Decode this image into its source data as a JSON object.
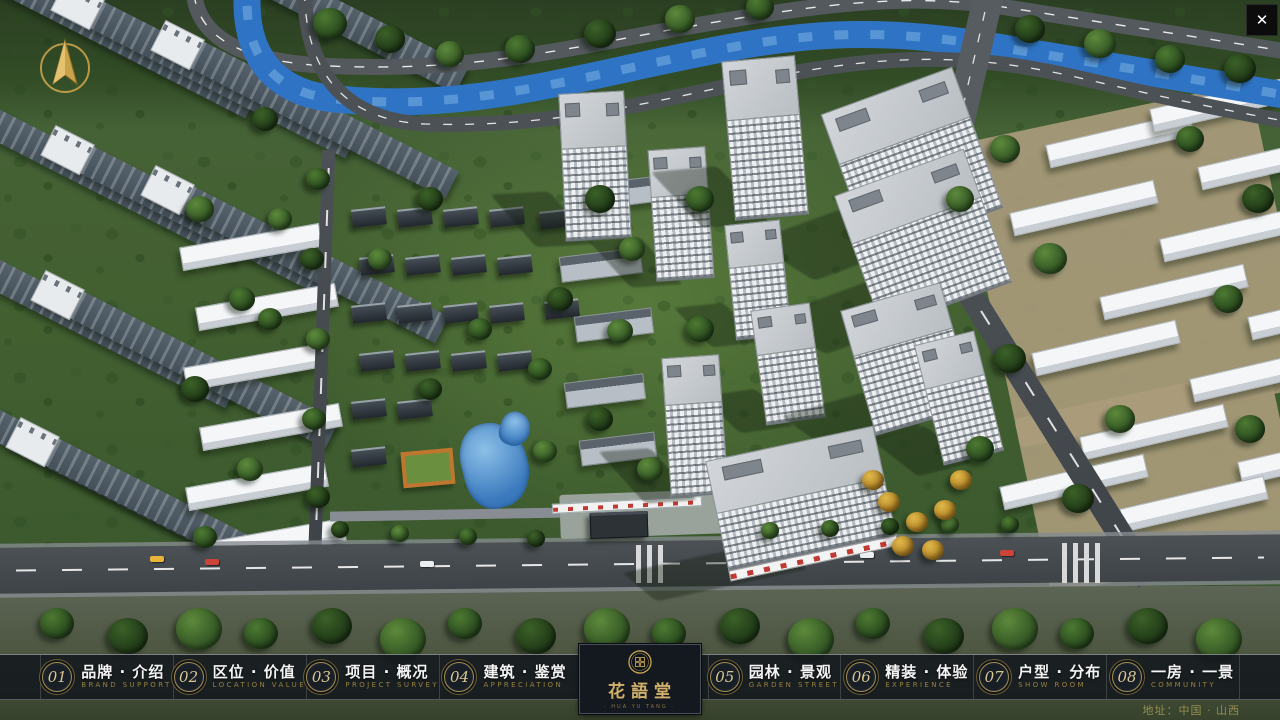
{
  "window": {
    "title": "花語堂 楼盘展示系统"
  },
  "icons": {
    "close": "✕",
    "compass": "north-arrow",
    "logo_seal": "hua-yu-tang-seal"
  },
  "nav": {
    "items": [
      {
        "num": "01",
        "label": "品牌 · 介绍",
        "sub": "BRAND SUPPORT"
      },
      {
        "num": "02",
        "label": "区位 · 价值",
        "sub": "LOCATION VALUE"
      },
      {
        "num": "03",
        "label": "项目 · 概况",
        "sub": "PROJECT SURVEY"
      },
      {
        "num": "04",
        "label": "建筑 · 鉴赏",
        "sub": "APPRECIATION"
      },
      {
        "num": "05",
        "label": "园林 · 景观",
        "sub": "GARDEN STREET"
      },
      {
        "num": "06",
        "label": "精装 · 体验",
        "sub": "EXPERIENCE"
      },
      {
        "num": "07",
        "label": "户型 · 分布",
        "sub": "SHOW ROOM"
      },
      {
        "num": "08",
        "label": "一房 · 一景",
        "sub": "COMMUNITY"
      }
    ]
  },
  "logo": {
    "title": "花語堂",
    "subtitle": "· HUA YU TANG ·"
  },
  "footer": {
    "address": "地址：中国 · 山西"
  },
  "colors": {
    "gold": "#c8a653",
    "nav_bg": "#12161d",
    "river": "#2f74c4",
    "accent_red": "#c03a34"
  }
}
